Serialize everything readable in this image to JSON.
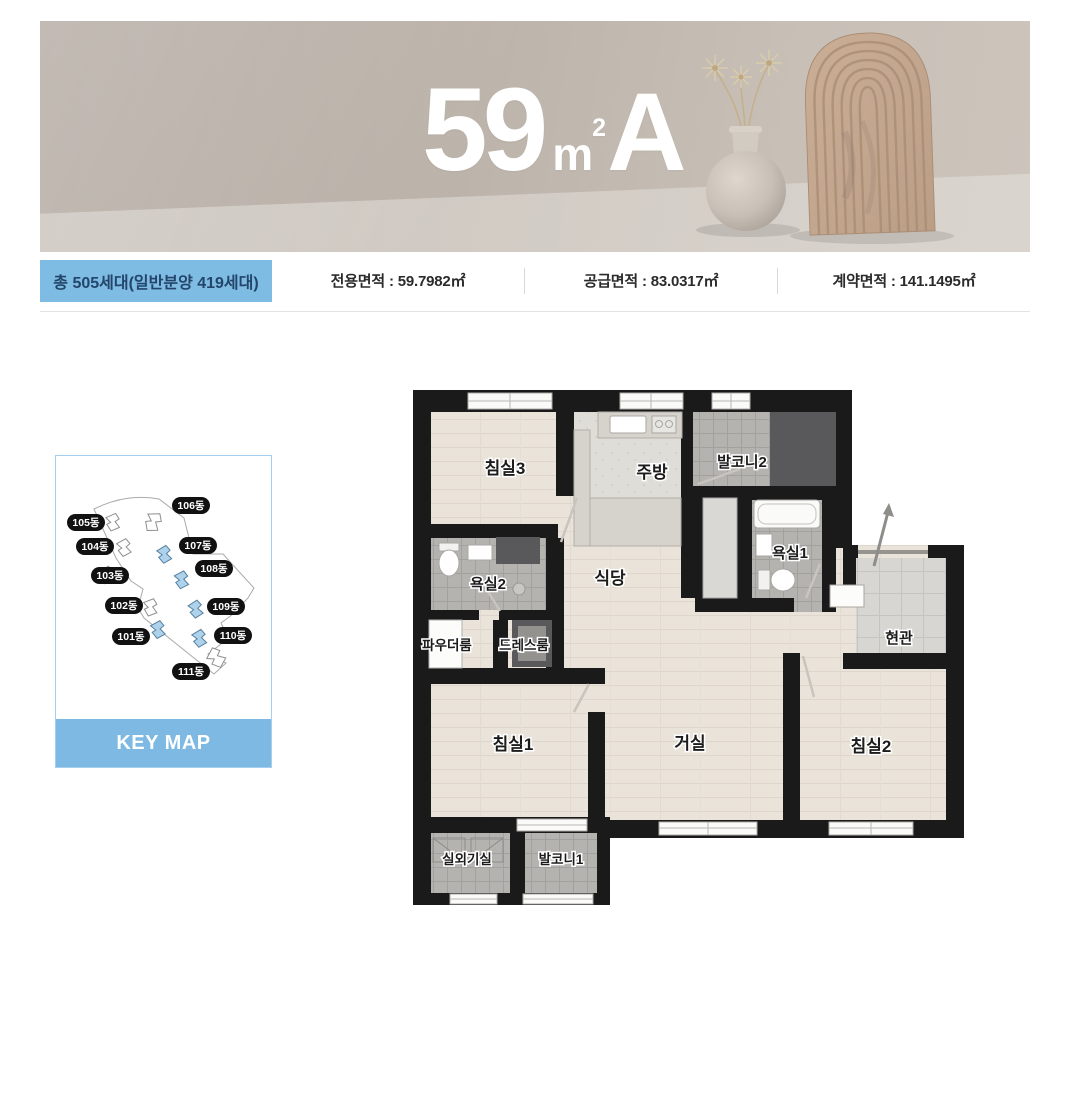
{
  "banner": {
    "title": {
      "number": "59",
      "unit": "m",
      "unit_sup": "2",
      "variant": "A"
    }
  },
  "info_bar": {
    "badge": "총 505세대(일반분양 419세대)",
    "items": [
      "전용면적 : 59.7982㎡",
      "공급면적 : 83.0317㎡",
      "계약면적 : 141.1495㎡"
    ]
  },
  "keymap": {
    "title": "KEY MAP",
    "building_labels": [
      "105동",
      "106동",
      "104동",
      "107동",
      "103동",
      "108동",
      "102동",
      "109동",
      "101동",
      "110동",
      "111동"
    ]
  },
  "floorplan": {
    "rooms": {
      "bedroom3": "침실3",
      "kitchen": "주방",
      "balcony2": "발코니2",
      "bath1": "욕실1",
      "entrance": "현관",
      "dining": "식당",
      "bath2": "욕실2",
      "powder": "파우더룸",
      "dress": "드레스룸",
      "bedroom1": "침실1",
      "living": "거실",
      "bedroom2": "침실2",
      "ac_room": "실외기실",
      "balcony1": "발코니1"
    }
  },
  "colors": {
    "accent_blue": "#7fbce4",
    "badge_text": "#23456a",
    "keymap_highlight": "#aed2ec",
    "wall_black": "#1a1a1a",
    "banner_beige": "#bbb2a9"
  }
}
